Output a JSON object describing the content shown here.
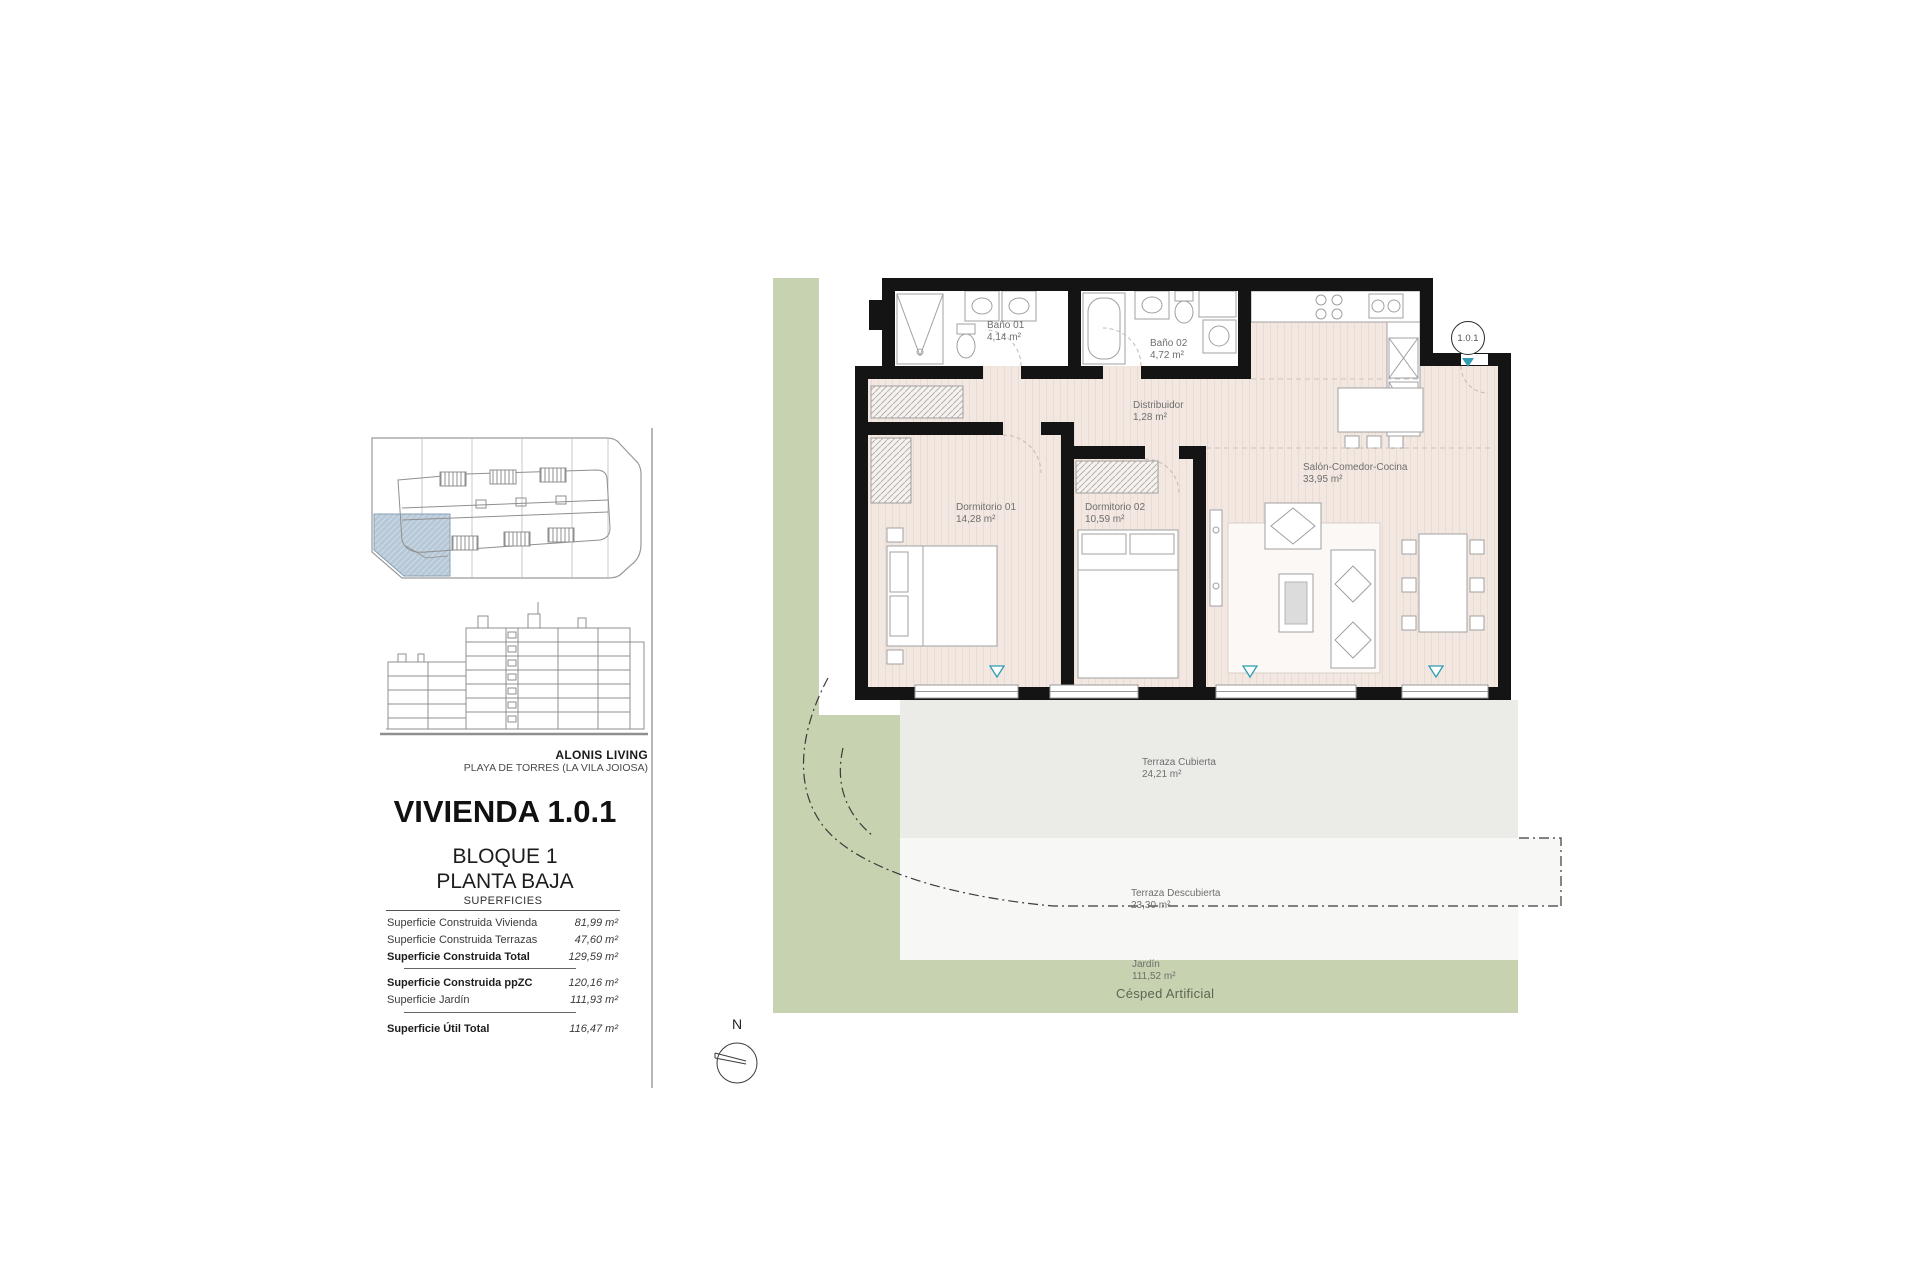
{
  "project": {
    "brand": "ALONIS LIVING",
    "location": "PLAYA DE TORRES (LA VILA JOIOSA)",
    "title": "VIVIENDA 1.0.1",
    "block": "BLOQUE 1",
    "floor": "PLANTA BAJA"
  },
  "superficies": {
    "header": "SUPERFICIES",
    "rows": [
      {
        "label": "Superficie Construida Vivienda",
        "value": "81,99 m²"
      },
      {
        "label": "Superficie Construida Terrazas",
        "value": "47,60 m²"
      },
      {
        "label": "Superficie Construida Total",
        "value": "129,59 m²"
      },
      {
        "label": "Superficie Construida ppZC",
        "value": "120,16 m²"
      },
      {
        "label": "Superficie Jardín",
        "value": "111,93 m²"
      },
      {
        "label": "Superficie Útil Total",
        "value": "116,47 m²"
      }
    ]
  },
  "plan": {
    "unit_marker": "1.0.1",
    "north_label": "N",
    "ground_label": "Césped Artificial",
    "rooms": [
      {
        "name": "Baño 01",
        "area": "4,14 m²"
      },
      {
        "name": "Baño 02",
        "area": "4,72 m²"
      },
      {
        "name": "Distribuidor",
        "area": "1,28 m²"
      },
      {
        "name": "Dormitorio 01",
        "area": "14,28 m²"
      },
      {
        "name": "Dormitorio 02",
        "area": "10,59 m²"
      },
      {
        "name": "Salón-Comedor-Cocina",
        "area": "33,95 m²"
      },
      {
        "name": "Terraza Cubierta",
        "area": "24,21 m²"
      },
      {
        "name": "Terraza Descubierta",
        "area": "23,30 m²"
      },
      {
        "name": "Jardín",
        "area": "111,52 m²"
      }
    ]
  },
  "colors": {
    "garden_green": "#c7d2b0",
    "floor_beige": "#f3e8e1",
    "terrace_gray": "#ebebe8",
    "accent_teal": "#2f9cb3",
    "unit_highlight_blue": "#b7c8d7",
    "wall_black": "#141414"
  }
}
